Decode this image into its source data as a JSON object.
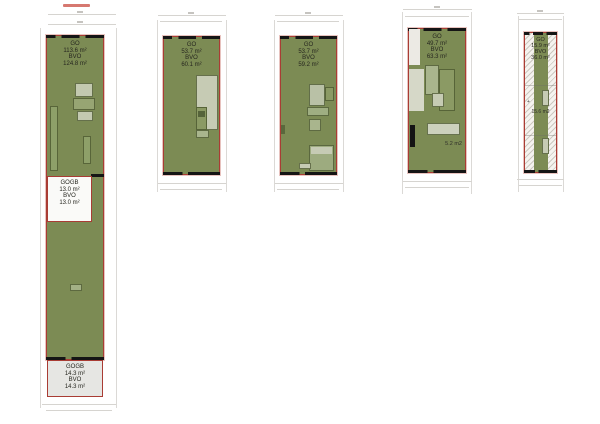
{
  "document": {
    "type": "floor-plan-sheet",
    "background": "#ffffff"
  },
  "colors": {
    "plan_fill": "#7c8b54",
    "plan_border": "#a93c34",
    "wall": "#151515",
    "gogb_white_fill": "#fafaf8",
    "gogb_gray_fill": "#e6e6e3",
    "hatch_bg": "#f5f3ef",
    "dim_line": "#d8d6d4",
    "label_text": "#26261f",
    "red_note": "#c84b40"
  },
  "plans": [
    {
      "name": "unit-1",
      "go_label": "GO",
      "go_value": "113.6 m²",
      "bvo_label": "BVO",
      "bvo_value": "124.8 m²",
      "sections": [
        {
          "label": "GOGB",
          "go_value": "13.0 m²",
          "bvo_label": "BVO",
          "bvo_value": "13.0 m²"
        },
        {
          "label": "GOGB",
          "go_value": "14.3 m²",
          "bvo_label": "BVO",
          "bvo_value": "14.3 m²"
        }
      ]
    },
    {
      "name": "unit-2",
      "go_label": "GO",
      "go_value": "53.7 m²",
      "bvo_label": "BVO",
      "bvo_value": "60.1 m²"
    },
    {
      "name": "unit-3",
      "go_label": "GO",
      "go_value": "53.7 m²",
      "bvo_label": "BVO",
      "bvo_value": "59.2 m²"
    },
    {
      "name": "unit-4",
      "go_label": "GO",
      "go_value": "49.7 m²",
      "bvo_label": "BVO",
      "bvo_value": "63.3 m²",
      "room_label": "5.2 m2"
    },
    {
      "name": "unit-5",
      "go_label": "GO",
      "go_value": "15.9 m²",
      "bvo_label": "BVO",
      "bvo_value": "36.0 m²",
      "room_label": "15.6 m2",
      "marker": "+"
    }
  ]
}
